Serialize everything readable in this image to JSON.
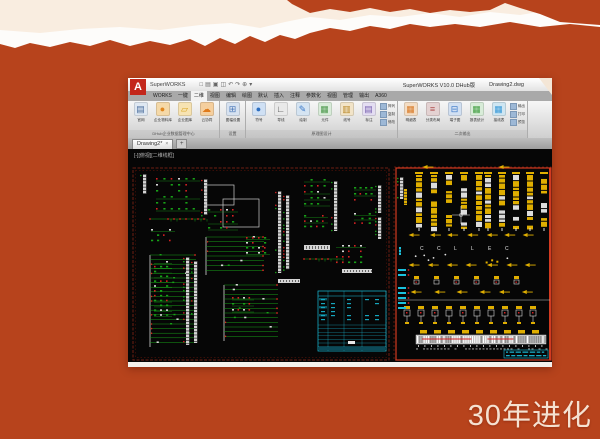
{
  "colors": {
    "bg": "#b7431c",
    "cream": "#f9ede0",
    "torn_white": "#fdfcfa",
    "canvas": "#060606",
    "green": "#18a018",
    "red": "#d42222",
    "wire_white": "#d6d6d6",
    "cyan": "#1ac2de",
    "yellow": "#dfae00",
    "sheet_dark": "#6e1e12",
    "sheet_dark2": "#491108",
    "sheet_bright": "#d23a20",
    "caption": "#f5e1d1",
    "logo_red": "#c3271b"
  },
  "caption": "30年进化",
  "window": {
    "logo": "A",
    "app_name": "SuperWORKS",
    "qat": [
      "□",
      "▤",
      "▣",
      "◫",
      "↶",
      "↷",
      "⊕",
      "▾"
    ],
    "title_version": "SuperWORKS V10.0 DHub版",
    "title_doc": "Drawing2.dwg",
    "menu_tabs": [
      "WORKS",
      "一键",
      "二维",
      "视图",
      "编辑",
      "绘图",
      "默认",
      "插入",
      "注释",
      "参数化",
      "视图",
      "管理",
      "输出",
      "A360"
    ],
    "active_tab_index": 2,
    "ribbon": {
      "groups": [
        {
          "label": "DHub企业数据管理中心",
          "buttons": [
            {
              "label": "官网",
              "icon": "website-icon",
              "g": "▤",
              "c": "#dfe8f2",
              "tc": "#4a6c9b"
            },
            {
              "label": "企业物料库",
              "icon": "parts-library-icon",
              "g": "●",
              "c": "#f5d9a8",
              "tc": "#e0871f"
            },
            {
              "label": "企业图库",
              "icon": "drawing-library-icon",
              "g": "▱",
              "c": "#f7e3b2",
              "tc": "#d8a018"
            },
            {
              "label": "云协同",
              "icon": "cloud-icon",
              "g": "☁",
              "c": "#f5cf9e",
              "tc": "#e07a1a"
            }
          ]
        },
        {
          "label": "设置",
          "buttons": [
            {
              "label": "图幅设置",
              "icon": "sheet-settings-icon",
              "g": "⊞",
              "c": "#d7e2f0",
              "tc": "#4a78b8"
            }
          ]
        },
        {
          "label": "原理图设计",
          "buttons": [
            {
              "label": "符号",
              "icon": "symbol-icon",
              "g": "●",
              "c": "#cfe0f4",
              "tc": "#2e6fc0"
            },
            {
              "label": "导线",
              "icon": "wire-icon",
              "g": "∟",
              "c": "#e9e9e9",
              "tc": "#555555"
            },
            {
              "label": "绘制",
              "icon": "draw-icon",
              "g": "✎",
              "c": "#d5e4f2",
              "tc": "#3a78c8"
            },
            {
              "label": "元件",
              "icon": "component-icon",
              "g": "▦",
              "c": "#d9ecd9",
              "tc": "#4e9a4e"
            },
            {
              "label": "线号",
              "icon": "wire-number-icon",
              "g": "▥",
              "c": "#f2e4c8",
              "tc": "#bb8a2a"
            },
            {
              "label": "标注",
              "icon": "annotate-icon",
              "g": "▤",
              "c": "#e4def2",
              "tc": "#7a62b0"
            }
          ],
          "small": [
            "阵列",
            "复制",
            "修改"
          ]
        },
        {
          "label": "二次输出",
          "buttons": [
            {
              "label": "明细表",
              "icon": "bom-icon",
              "g": "▦",
              "c": "#f4ddc4",
              "tc": "#d87a28"
            },
            {
              "label": "分类布局",
              "icon": "layout-icon",
              "g": "≡",
              "c": "#e4d2d2",
              "tc": "#b05050"
            },
            {
              "label": "端子图",
              "icon": "terminal-icon",
              "g": "⊟",
              "c": "#d2e0f2",
              "tc": "#3a78c8"
            },
            {
              "label": "报表统计",
              "icon": "report-icon",
              "g": "▦",
              "c": "#d8ecd8",
              "tc": "#44a044"
            },
            {
              "label": "接线表",
              "icon": "wiring-table-icon",
              "g": "▦",
              "c": "#cfe6f2",
              "tc": "#3a9ad8"
            }
          ],
          "small": [
            "输出",
            "打印",
            "预览"
          ]
        }
      ]
    },
    "doc_tab": "Drawing2*",
    "doc_tab_close": "×",
    "doc_tab_add": "+",
    "viewport_label": "[-][俯视][二维线框]"
  },
  "canvas": {
    "sheets": [
      {
        "name": "schematic-sheet",
        "style": "dark",
        "x": 5,
        "y": 19,
        "w": 256,
        "h": 192,
        "items": [
          {
            "t": "rail",
            "x": 15,
            "y": 25,
            "h": 20
          },
          {
            "t": "grid",
            "x": 28,
            "y": 29,
            "w": 44,
            "h": 36,
            "rows": 6,
            "cols": 6
          },
          {
            "t": "rail",
            "x": 76,
            "y": 30,
            "h": 36
          },
          {
            "t": "dotline",
            "x": 22,
            "y": 70,
            "w": 56
          },
          {
            "t": "grid",
            "x": 23,
            "y": 80,
            "w": 24,
            "h": 16,
            "rows": 3,
            "cols": 4
          },
          {
            "t": "box",
            "x": 78,
            "y": 36,
            "w": 28,
            "h": 20
          },
          {
            "t": "box",
            "x": 95,
            "y": 50,
            "w": 36,
            "h": 28
          },
          {
            "t": "grid",
            "x": 80,
            "y": 60,
            "w": 30,
            "h": 24,
            "rows": 4,
            "cols": 5
          },
          {
            "t": "ladder",
            "x": 78,
            "y": 88,
            "w": 58,
            "h": 38,
            "rungs": 8
          },
          {
            "t": "grid",
            "x": 118,
            "y": 88,
            "w": 24,
            "h": 20,
            "rows": 4,
            "cols": 4
          },
          {
            "t": "rail",
            "x": 150,
            "y": 42,
            "h": 82
          },
          {
            "t": "rail",
            "x": 158,
            "y": 46,
            "h": 74
          },
          {
            "t": "grid",
            "x": 176,
            "y": 30,
            "w": 26,
            "h": 30,
            "rows": 5,
            "cols": 4
          },
          {
            "t": "rail",
            "x": 206,
            "y": 32,
            "h": 50
          },
          {
            "t": "grid",
            "x": 176,
            "y": 66,
            "w": 24,
            "h": 16,
            "rows": 3,
            "cols": 4
          },
          {
            "t": "grid",
            "x": 226,
            "y": 38,
            "w": 22,
            "h": 18,
            "rows": 3,
            "cols": 4
          },
          {
            "t": "rail",
            "x": 250,
            "y": 36,
            "h": 28
          },
          {
            "t": "grid",
            "x": 226,
            "y": 64,
            "w": 22,
            "h": 14,
            "rows": 3,
            "cols": 3
          },
          {
            "t": "rail",
            "x": 250,
            "y": 68,
            "h": 22
          },
          {
            "t": "whitebar",
            "x": 176,
            "y": 96,
            "w": 26,
            "h": 5
          },
          {
            "t": "grid",
            "x": 208,
            "y": 96,
            "w": 30,
            "h": 22,
            "rows": 4,
            "cols": 5
          },
          {
            "t": "ladder",
            "x": 22,
            "y": 106,
            "w": 46,
            "h": 92,
            "rungs": 20
          },
          {
            "t": "rail",
            "x": 58,
            "y": 108,
            "h": 88
          },
          {
            "t": "rail",
            "x": 66,
            "y": 112,
            "h": 82
          },
          {
            "t": "grid",
            "x": 26,
            "y": 112,
            "w": 18,
            "h": 58,
            "rows": 12,
            "cols": 3
          },
          {
            "t": "ladder",
            "x": 96,
            "y": 136,
            "w": 54,
            "h": 56,
            "rungs": 12
          },
          {
            "t": "grid",
            "x": 104,
            "y": 148,
            "w": 22,
            "h": 18,
            "rows": 3,
            "cols": 4
          },
          {
            "t": "whitebar",
            "x": 150,
            "y": 130,
            "w": 22,
            "h": 4
          },
          {
            "t": "whitebar",
            "x": 214,
            "y": 120,
            "w": 30,
            "h": 4
          },
          {
            "t": "cyantable",
            "x": 190,
            "y": 142,
            "w": 68,
            "h": 60
          },
          {
            "t": "dotline",
            "x": 176,
            "y": 110,
            "w": 40
          }
        ]
      },
      {
        "name": "layout-sheet",
        "style": "bright",
        "x": 268,
        "y": 19,
        "w": 155,
        "h": 192,
        "items": [
          {
            "t": "arrows",
            "x": 296,
            "y": 16,
            "n": 1,
            "gap": 0
          },
          {
            "t": "arrows",
            "x": 372,
            "y": 16,
            "n": 1,
            "gap": 0
          },
          {
            "t": "rail",
            "x": 272,
            "y": 28,
            "h": 22
          },
          {
            "t": "devgroup",
            "x": 288,
            "y": 26,
            "cols": 5,
            "colw": 6,
            "gap": 9,
            "h": 52
          },
          {
            "t": "devgroup",
            "x": 357,
            "y": 26,
            "cols": 5,
            "colw": 6,
            "gap": 8,
            "h": 52
          },
          {
            "t": "vbar",
            "x": 276,
            "y": 40,
            "w": 3,
            "h": 16,
            "c": "yellow"
          },
          {
            "t": "arrows",
            "x": 282,
            "y": 84,
            "n": 7,
            "gap": 19
          },
          {
            "t": "lrow",
            "x": 292,
            "y": 101,
            "letters": [
              "C",
              "C",
              "L",
              "L",
              "E",
              "C"
            ],
            "gap": 17
          },
          {
            "t": "scatter",
            "x": 286,
            "y": 104,
            "w": 120,
            "h": 10
          },
          {
            "t": "arrows",
            "x": 282,
            "y": 114,
            "n": 7,
            "gap": 19
          },
          {
            "t": "pairs",
            "x": 286,
            "y": 127,
            "n": 6,
            "gap": 20
          },
          {
            "t": "arrows",
            "x": 284,
            "y": 141,
            "n": 6,
            "gap": 22
          },
          {
            "t": "hline",
            "x": 270,
            "y": 151,
            "w": 152
          },
          {
            "t": "pairs2",
            "x": 276,
            "y": 157,
            "n": 10,
            "gap": 14
          },
          {
            "t": "strip",
            "x": 288,
            "y": 186,
            "w": 130,
            "h": 9
          },
          {
            "t": "cyantext",
            "x": 376,
            "y": 201,
            "w": 44,
            "h": 8
          },
          {
            "t": "cyanlist",
            "x": 270,
            "y": 138,
            "n": 5
          },
          {
            "t": "cyanlist",
            "x": 270,
            "y": 120,
            "n": 2
          },
          {
            "t": "cross",
            "x": 333,
            "y": 66
          },
          {
            "t": "vbar",
            "x": 271,
            "y": 98,
            "w": 2,
            "h": 8,
            "c": "cyan"
          }
        ]
      }
    ]
  }
}
